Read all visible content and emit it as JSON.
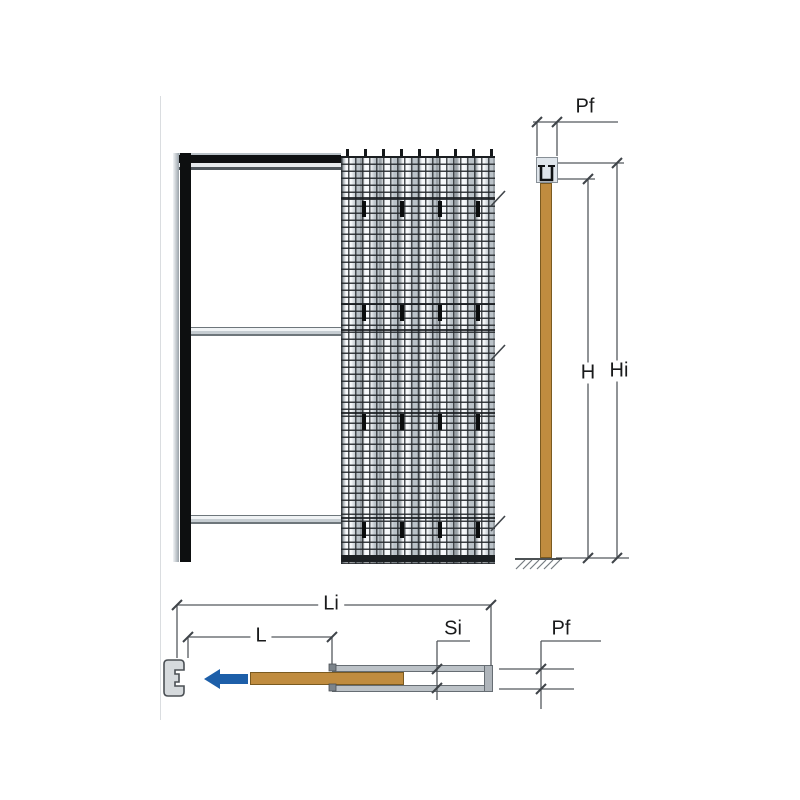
{
  "drawing": {
    "type": "pocket-sliding-door-counterframe-technical-drawing",
    "views": {
      "front_elevation": "door frame with wire-mesh pocket panel",
      "side_section": "vertical section with track and door leaf",
      "plan_section": "horizontal section with pocket, door leaf and jamb"
    },
    "dimensions": {
      "pf_side": "Pf",
      "h": "H",
      "hi": "Hi",
      "li": "Li",
      "l": "L",
      "si": "Si",
      "pf_plan": "Pf"
    },
    "colors": {
      "door_wood": "#c08c3f",
      "arrow_blue": "#1d5fa9",
      "mesh_background": "#e7ebee",
      "mesh_grid_line": "#23272b",
      "track_black": "#0e1012",
      "metal_silver": "#c6cdd2",
      "dimension_line": "#55595e"
    }
  }
}
